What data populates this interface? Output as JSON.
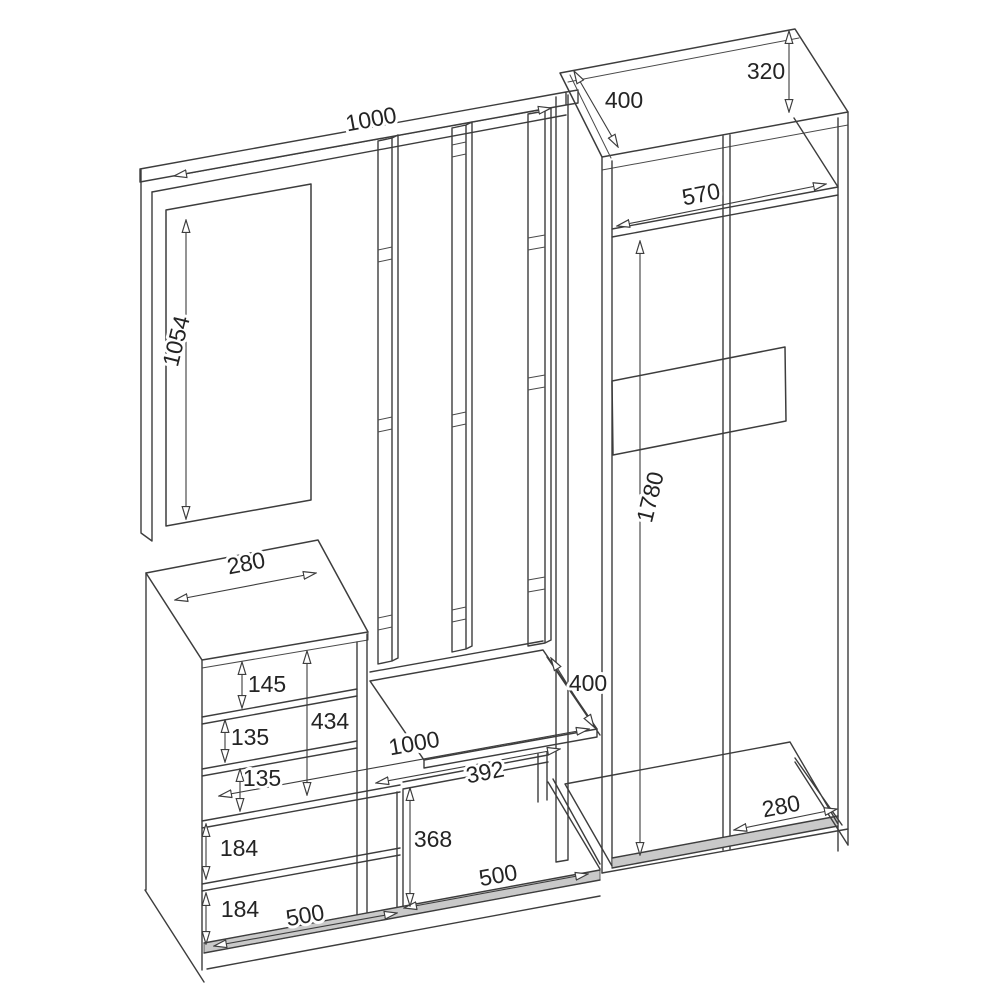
{
  "drawing": {
    "type": "furniture-assembly-dimension-diagram",
    "subject": "hallway-set-isometric-wireframe",
    "canvas": {
      "width": 1000,
      "height": 1000,
      "background": "#ffffff"
    },
    "style": {
      "line_color": "#3d3d3d",
      "dimension_color": "#3d3d3d",
      "text_color": "#242424",
      "plinth_fill": "#c9c9c9"
    },
    "dimensions": {
      "panel_width": "1000",
      "mirror_height": "1054",
      "wardrobe_top_depth": "400",
      "wardrobe_top_section_height": "320",
      "wardrobe_interior_width": "570",
      "wardrobe_interior_height": "1780",
      "wardrobe_bottom_depth": "280",
      "cabinet_top_depth": "280",
      "cabinet_compartment_height_1": "145",
      "cabinet_section_height": "434",
      "cabinet_compartment_height_2": "135",
      "cabinet_compartment_height_3": "135",
      "bench_seat_depth": "400",
      "bench_width": "1000",
      "bench_opening_width": "392",
      "bench_opening_height": "368",
      "shoe_shelf_gap_1": "184",
      "shoe_shelf_gap_2": "184",
      "compartment_width_left": "500",
      "compartment_width_right": "500"
    }
  }
}
